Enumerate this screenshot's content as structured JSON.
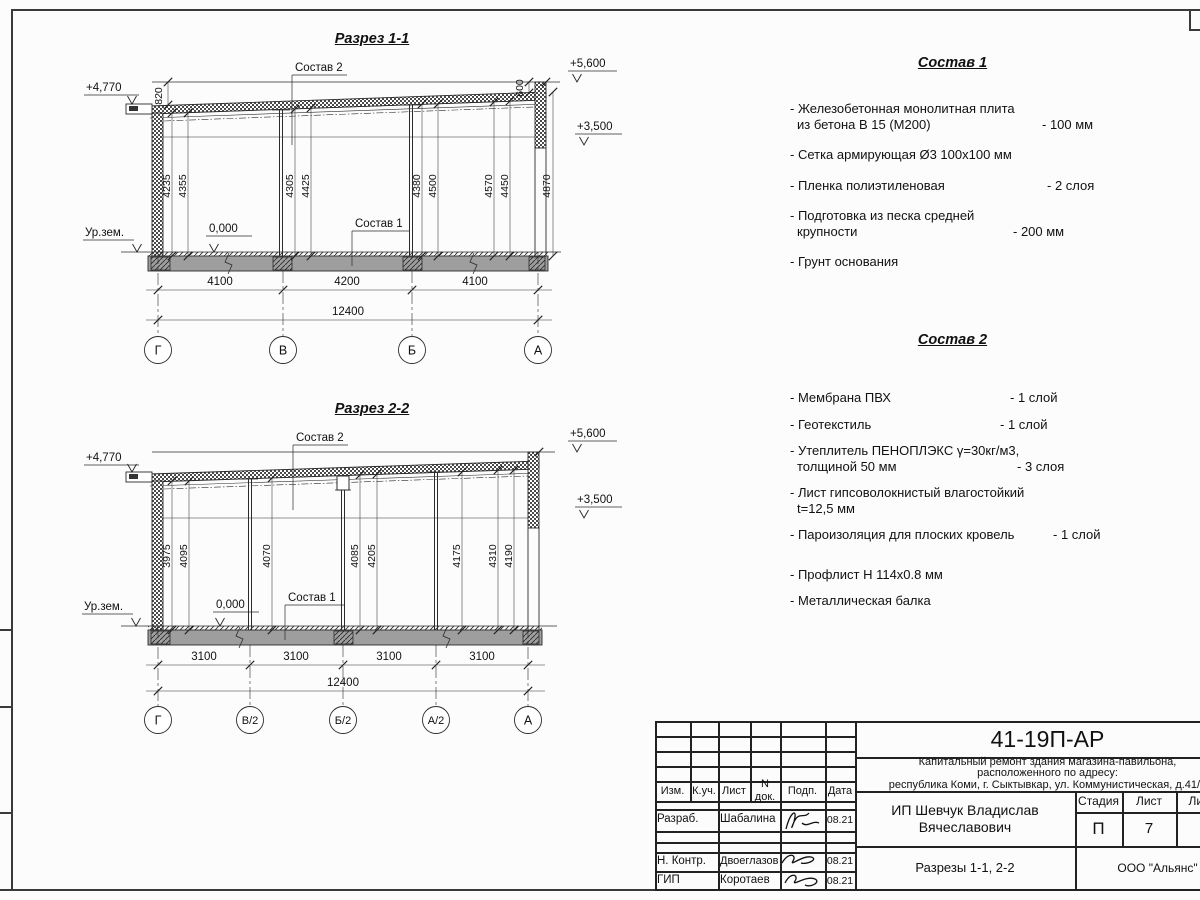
{
  "s1": {
    "title": "Разрез 1-1",
    "label_sostav2": "Состав 2",
    "label_sostav1": "Состав 1",
    "elev_left": "+4,770",
    "elev_top": "+5,600",
    "elev_mid": "+3,500",
    "ground": "Ур.зем.",
    "zero": "0,000",
    "dim_left": "820",
    "dim_right": "600",
    "dim_height": "4870",
    "vdims": [
      "4235",
      "4355",
      "4305",
      "4425",
      "4380",
      "4500",
      "4570",
      "4450"
    ],
    "hdims": [
      "4100",
      "4200",
      "4100"
    ],
    "total": "12400",
    "axes": [
      "Г",
      "В",
      "Б",
      "А"
    ]
  },
  "s2": {
    "title": "Разрез 2-2",
    "label_sostav2": "Состав 2",
    "label_sostav1": "Состав 1",
    "elev_left": "+4,770",
    "elev_top": "+5,600",
    "elev_mid": "+3,500",
    "ground": "Ур.зем.",
    "zero": "0,000",
    "vdims": [
      "3975",
      "4095",
      "4070",
      "4085",
      "4205",
      "4175",
      "4310",
      "4190"
    ],
    "hdims": [
      "3100",
      "3100",
      "3100",
      "3100"
    ],
    "total": "12400",
    "axes": [
      "Г",
      "В/2",
      "Б/2",
      "А/2",
      "А"
    ]
  },
  "sostav1": {
    "title": "Состав 1",
    "items": [
      {
        "l1": "- Железобетонная  монолитная плита",
        "l2": "из бетона В 15 (М200)",
        "value": "- 100 мм"
      },
      {
        "l1": "- Сетка армирующая Ø3 100х100 мм",
        "l2": "",
        "value": ""
      },
      {
        "l1": "- Пленка полиэтиленовая",
        "l2": "",
        "value": "- 2 слоя"
      },
      {
        "l1": "- Подготовка из песка средней",
        "l2": "крупности",
        "value": "- 200 мм"
      },
      {
        "l1": "- Грунт основания",
        "l2": "",
        "value": ""
      }
    ]
  },
  "sostav2": {
    "title": "Состав 2",
    "items": [
      {
        "l1": "- Мембрана ПВХ",
        "l2": "",
        "value": "- 1 слой"
      },
      {
        "l1": "- Геотекстиль",
        "l2": "",
        "value": "- 1 слой"
      },
      {
        "l1": "- Утеплитель ПЕНОПЛЭКС γ=30кг/м3,",
        "l2": "толщиной 50 мм",
        "value": "- 3 слоя"
      },
      {
        "l1": "- Лист гипсоволокнистый влагостойкий",
        "l2": "t=12,5 мм",
        "value": ""
      },
      {
        "l1": "- Пароизоляция для плоских кровель",
        "l2": "",
        "value": "- 1 слой"
      },
      {
        "l1": "- Профлист Н 114х0.8 мм",
        "l2": "",
        "value": ""
      },
      {
        "l1": "- Металлическая балка",
        "l2": "",
        "value": ""
      }
    ]
  },
  "titleblock": {
    "code": "41-19П-АР",
    "desc_line1": "Капитальный ремонт здания магазина-павильона,",
    "desc_line2": "расположенного по адресу:",
    "desc_line3": "республика Коми, г. Сыктывкар, ул. Коммунистическая, д.41/1",
    "col_izm": "Изм.",
    "col_kuch": "К.уч.",
    "col_list": "Лист",
    "col_ndok": "N док.",
    "col_podp": "Подп.",
    "col_data": "Дата",
    "row1_role": "Разраб.",
    "row1_name": "Шабалина",
    "row1_date": "08.21",
    "row2_role": "Н. Контр.",
    "row2_name": "Двоеглазов",
    "row2_date": "08.21",
    "row3_role": "ГИП",
    "row3_name": "Коротаев",
    "row3_date": "08.21",
    "client": "ИП Шевчук Владислав Вячеславович",
    "stage_label": "Стадия",
    "sheet_label": "Лист",
    "sheets_label": "Листов",
    "stage": "П",
    "sheet_no": "7",
    "doc_title": "Разрезы 1-1, 2-2",
    "org": "ООО \"Альянс\""
  }
}
